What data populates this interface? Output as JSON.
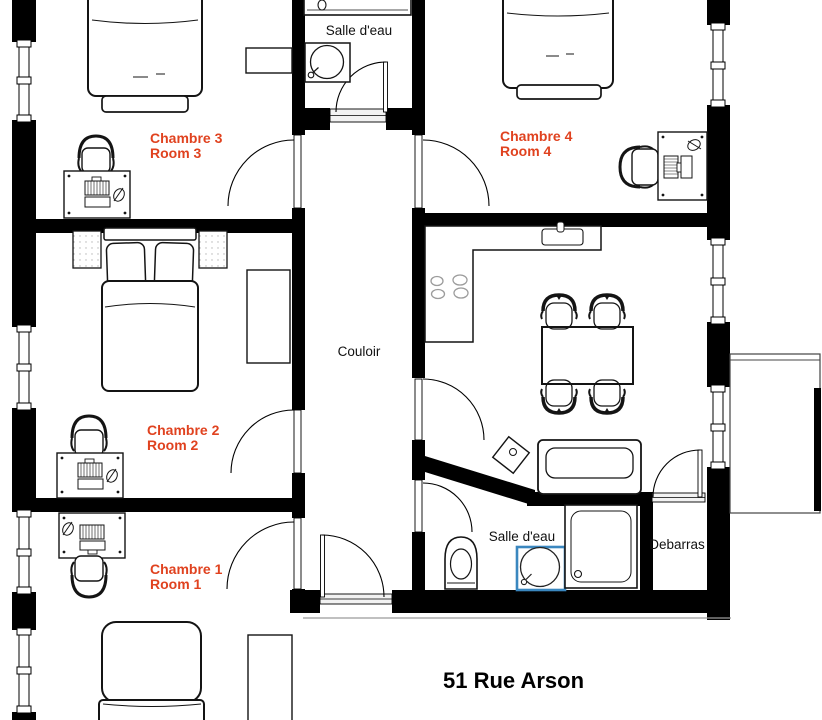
{
  "plan": {
    "title": "51 Rue Arson",
    "colors": {
      "room_label": "#e0421f",
      "highlight_sink": "#3a87bf",
      "walls": "#000000"
    },
    "labels": {
      "chambre3": {
        "fr": "Chambre 3",
        "en": "Room 3"
      },
      "chambre4": {
        "fr": "Chambre 4",
        "en": "Room 4"
      },
      "chambre2": {
        "fr": "Chambre 2",
        "en": "Room 2"
      },
      "chambre1": {
        "fr": "Chambre 1",
        "en": "Room 1"
      },
      "bathroom_top": "Salle d'eau",
      "bathroom_bottom": "Salle d'eau",
      "corridor": "Couloir",
      "storage": "Debarras"
    }
  }
}
